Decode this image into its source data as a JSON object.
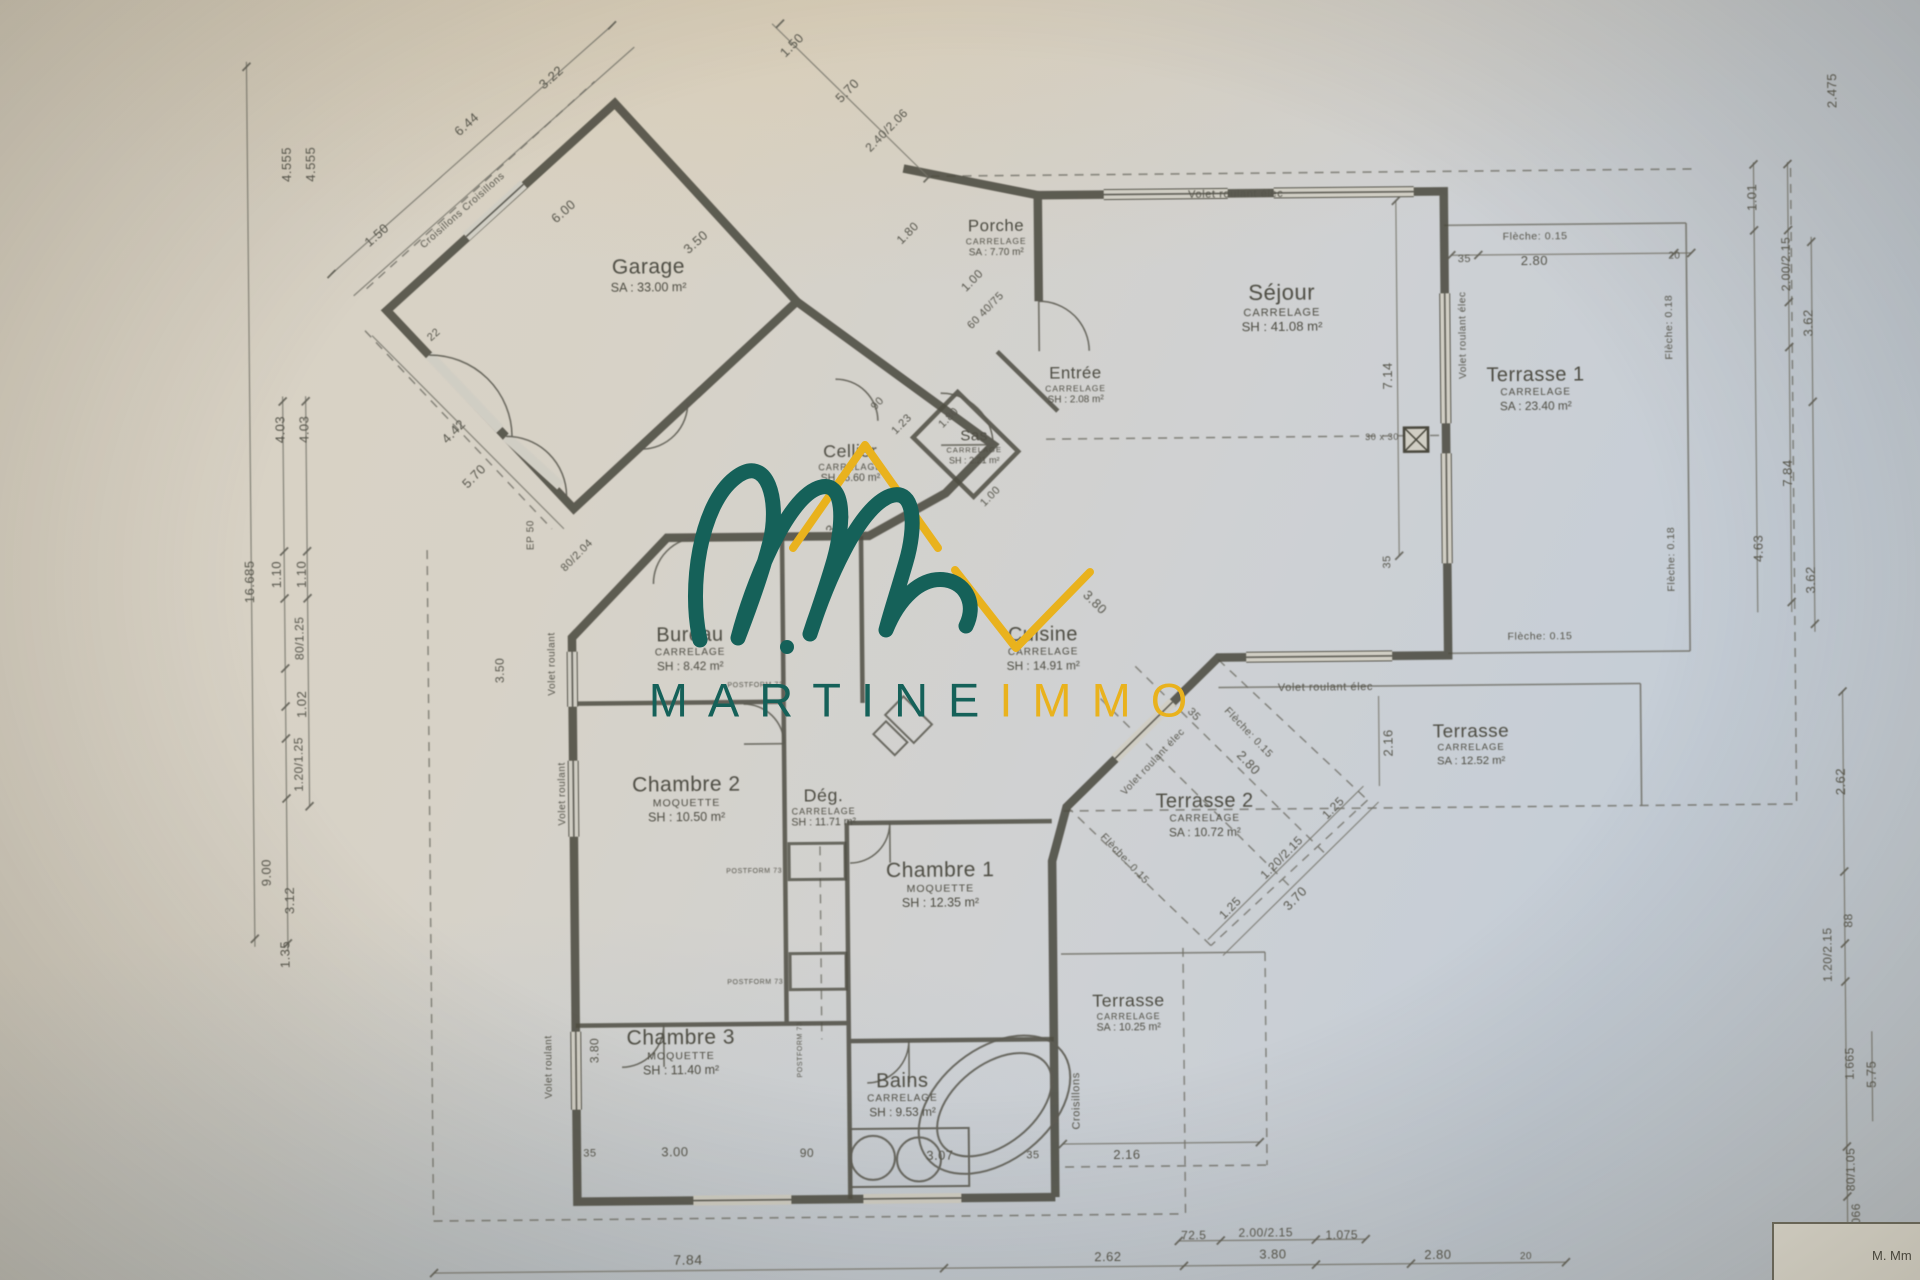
{
  "photo": {
    "accent_teal": "#156159",
    "accent_gold": "#e9b21d",
    "paper": "#d5d0c6",
    "ink": "#4c4b41"
  },
  "watermark": {
    "logo": "martineimmo-roof-and-script-m",
    "text_primary": "MARTINE",
    "text_secondary": "IMMO"
  },
  "title_block": {
    "text": "M. Mm"
  },
  "rooms": [
    {
      "id": "garage",
      "name": "Garage",
      "finish": "",
      "area": "SA : 33.00 m²",
      "x": 652,
      "y": 272,
      "scale": 1
    },
    {
      "id": "porche",
      "name": "Porche",
      "finish": "CARRELAGE",
      "area": "SA : 7.70 m²",
      "x": 1000,
      "y": 238,
      "scale": 0.8
    },
    {
      "id": "entree",
      "name": "Entrée",
      "finish": "CARRELAGE",
      "area": "SH : 2.08 m²",
      "x": 1078,
      "y": 386,
      "scale": 0.8
    },
    {
      "id": "sas",
      "name": "Sas",
      "finish": "CARRELAGE",
      "area": "SH : 2.21 m²",
      "x": 976,
      "y": 447,
      "scale": 0.72
    },
    {
      "id": "cellier",
      "name": "Cellier",
      "finish": "CARRELAGE",
      "area": "SH : 6.60 m²",
      "x": 852,
      "y": 462,
      "scale": 0.85
    },
    {
      "id": "sejour",
      "name": "Séjour",
      "finish": "CARRELAGE",
      "area": "SH : 41.08 m²",
      "x": 1285,
      "y": 311,
      "scale": 1.05
    },
    {
      "id": "terrasse1",
      "name": "Terrasse 1",
      "finish": "CARRELAGE",
      "area": "SA : 23.40 m²",
      "x": 1538,
      "y": 394,
      "scale": 0.95
    },
    {
      "id": "bureau",
      "name": "Bureau",
      "finish": "CARRELAGE",
      "area": "SH : 8.42 m²",
      "x": 690,
      "y": 646,
      "scale": 0.95
    },
    {
      "id": "cuisine",
      "name": "Cuisine",
      "finish": "CARRELAGE",
      "area": "SH : 14.91 m²",
      "x": 1043,
      "y": 649,
      "scale": 0.95
    },
    {
      "id": "chambre2",
      "name": "Chambre 2",
      "finish": "MOQUETTE",
      "area": "SH : 10.50 m²",
      "x": 685,
      "y": 796,
      "scale": 1
    },
    {
      "id": "degagement",
      "name": "Dég.",
      "finish": "CARRELAGE",
      "area": "SH : 11.71 m²",
      "x": 822,
      "y": 806,
      "scale": 0.85
    },
    {
      "id": "chambre1",
      "name": "Chambre 1",
      "finish": "MOQUETTE",
      "area": "SH : 12.35 m²",
      "x": 938,
      "y": 884,
      "scale": 1
    },
    {
      "id": "terrasse2",
      "name": "Terrasse 2",
      "finish": "CARRELAGE",
      "area": "SA : 10.72 m²",
      "x": 1203,
      "y": 817,
      "scale": 0.95
    },
    {
      "id": "terrasse_est",
      "name": "Terrasse",
      "finish": "CARRELAGE",
      "area": "SA : 12.52 m²",
      "x": 1470,
      "y": 749,
      "scale": 0.9
    },
    {
      "id": "chambre3",
      "name": "Chambre 3",
      "finish": "MOQUETTE",
      "area": "SH : 11.40 m²",
      "x": 677,
      "y": 1049,
      "scale": 1
    },
    {
      "id": "bains",
      "name": "Bains",
      "finish": "CARRELAGE",
      "area": "SH : 9.53 m²",
      "x": 898,
      "y": 1094,
      "scale": 0.95
    },
    {
      "id": "terrasse_sud",
      "name": "Terrasse",
      "finish": "CARRELAGE",
      "area": "SA : 10.25 m²",
      "x": 1125,
      "y": 1014,
      "scale": 0.85
    }
  ],
  "annotations": [
    {
      "t": "Volet roulant élec",
      "x": 1240,
      "y": 197,
      "r": 0,
      "s": 11
    },
    {
      "t": "Volet roulant élec",
      "x": 1325,
      "y": 691,
      "r": 0,
      "s": 11
    },
    {
      "t": "Volet roulant élec",
      "x": 1466,
      "y": 340,
      "r": -90,
      "s": 10
    },
    {
      "t": "Volet roulant élec",
      "x": 1152,
      "y": 764,
      "r": -46,
      "s": 10
    },
    {
      "t": "Volet roulant",
      "x": 552,
      "y": 660,
      "r": -90,
      "s": 10
    },
    {
      "t": "Volet roulant",
      "x": 561,
      "y": 790,
      "r": -90,
      "s": 10
    },
    {
      "t": "Volet roulant",
      "x": 545,
      "y": 1063,
      "r": -90,
      "s": 10
    },
    {
      "t": "EP 50",
      "x": 532,
      "y": 531,
      "r": -90,
      "s": 10
    },
    {
      "t": "Croisillons",
      "x": 1072,
      "y": 1102,
      "r": -90,
      "s": 11
    },
    {
      "t": "Croisillons      Croisillons",
      "x": 467,
      "y": 206,
      "r": -41,
      "s": 10
    },
    {
      "t": "POSTFORM 73",
      "x": 755,
      "y": 684,
      "r": 0,
      "s": 7
    },
    {
      "t": "POSTFORM 73",
      "x": 752,
      "y": 870,
      "r": 0,
      "s": 7
    },
    {
      "t": "POSTFORM 73",
      "x": 752,
      "y": 981,
      "r": 0,
      "s": 7
    },
    {
      "t": "POSTFORM 73",
      "x": 797,
      "y": 1048,
      "r": -90,
      "s": 7
    },
    {
      "t": "30 x 30",
      "x": 1384,
      "y": 441,
      "r": 0,
      "s": 9
    },
    {
      "t": "Flèche: 0.15",
      "x": 1539,
      "y": 243,
      "r": 0,
      "s": 10.5
    },
    {
      "t": "Flèche: 0.15",
      "x": 1540,
      "y": 643,
      "r": 0,
      "s": 10.5
    },
    {
      "t": "Flèche: 0.18",
      "x": 1673,
      "y": 334,
      "r": -90,
      "s": 10.5
    },
    {
      "t": "Flèche: 0.18",
      "x": 1673,
      "y": 566,
      "r": -90,
      "s": 10.5
    },
    {
      "t": "Flèche: 0.15",
      "x": 1247,
      "y": 736,
      "r": 47,
      "s": 10.5
    },
    {
      "t": "Flèche: 0.15",
      "x": 1122,
      "y": 861,
      "r": 47,
      "s": 10.5
    }
  ],
  "dimensions": [
    {
      "t": "6.44",
      "x": 472,
      "y": 120,
      "r": -41,
      "s": 13
    },
    {
      "t": "3.22",
      "x": 557,
      "y": 74,
      "r": -41,
      "s": 13
    },
    {
      "t": "1.50",
      "x": 381,
      "y": 230,
      "r": -41,
      "s": 13
    },
    {
      "t": "6.00",
      "x": 568,
      "y": 208,
      "r": -41,
      "s": 13
    },
    {
      "t": "3.50",
      "x": 700,
      "y": 240,
      "r": -41,
      "s": 13
    },
    {
      "t": "22",
      "x": 437,
      "y": 330,
      "r": -41,
      "s": 11
    },
    {
      "t": "4.42",
      "x": 456,
      "y": 427,
      "r": -45,
      "s": 13
    },
    {
      "t": "5.70",
      "x": 476,
      "y": 472,
      "r": -45,
      "s": 13
    },
    {
      "t": "3.00",
      "x": 839,
      "y": 522,
      "r": -45,
      "s": 13
    },
    {
      "t": "80/2.04",
      "x": 578,
      "y": 552,
      "r": -45,
      "s": 11
    },
    {
      "t": "1.50",
      "x": 798,
      "y": 44,
      "r": -45,
      "s": 13
    },
    {
      "t": "5.70",
      "x": 853,
      "y": 90,
      "r": -45,
      "s": 13
    },
    {
      "t": "2.40/2.06",
      "x": 892,
      "y": 130,
      "r": -45,
      "s": 12
    },
    {
      "t": "1.80",
      "x": 912,
      "y": 233,
      "r": -45,
      "s": 12
    },
    {
      "t": "1.00",
      "x": 976,
      "y": 281,
      "r": -45,
      "s": 12
    },
    {
      "t": "60 40/75",
      "x": 989,
      "y": 311,
      "r": -45,
      "s": 11
    },
    {
      "t": "90",
      "x": 880,
      "y": 403,
      "r": -45,
      "s": 11
    },
    {
      "t": "1.23",
      "x": 904,
      "y": 424,
      "r": -45,
      "s": 11
    },
    {
      "t": "1.80",
      "x": 951,
      "y": 418,
      "r": -45,
      "s": 11
    },
    {
      "t": "1.00",
      "x": 992,
      "y": 497,
      "r": -45,
      "s": 11
    },
    {
      "t": "3.80",
      "x": 1095,
      "y": 604,
      "r": 45,
      "s": 13
    },
    {
      "t": "35",
      "x": 1193,
      "y": 717,
      "r": 47,
      "s": 11
    },
    {
      "t": "2.80",
      "x": 1247,
      "y": 766,
      "r": 47,
      "s": 13
    },
    {
      "t": "1.25",
      "x": 1228,
      "y": 911,
      "r": -45,
      "s": 12
    },
    {
      "t": "1.20/2.15",
      "x": 1280,
      "y": 861,
      "r": -45,
      "s": 12
    },
    {
      "t": "1.25",
      "x": 1332,
      "y": 812,
      "r": -45,
      "s": 12
    },
    {
      "t": "3.70",
      "x": 1293,
      "y": 902,
      "r": -45,
      "s": 13
    },
    {
      "t": "35",
      "x": 1468,
      "y": 264,
      "r": 0,
      "s": 11
    },
    {
      "t": "2.80",
      "x": 1538,
      "y": 267,
      "r": 0,
      "s": 13
    },
    {
      "t": "20",
      "x": 1678,
      "y": 263,
      "r": 0,
      "s": 10
    },
    {
      "t": "7.14",
      "x": 1391,
      "y": 380,
      "r": -90,
      "s": 13
    },
    {
      "t": "35",
      "x": 1388,
      "y": 566,
      "r": -90,
      "s": 11
    },
    {
      "t": "2.16",
      "x": 1388,
      "y": 747,
      "r": -90,
      "s": 13
    },
    {
      "t": "2.16",
      "x": 1122,
      "y": 1157,
      "r": 0,
      "s": 13
    },
    {
      "t": "4.555",
      "x": 292,
      "y": 158,
      "r": -90,
      "s": 13
    },
    {
      "t": "4.555",
      "x": 316,
      "y": 158,
      "r": -90,
      "s": 13
    },
    {
      "t": "4.03",
      "x": 283,
      "y": 423,
      "r": -90,
      "s": 13
    },
    {
      "t": "4.03",
      "x": 307,
      "y": 423,
      "r": -90,
      "s": 13
    },
    {
      "t": "16.685",
      "x": 251,
      "y": 575,
      "r": -90,
      "s": 13
    },
    {
      "t": "1.10",
      "x": 278,
      "y": 568,
      "r": -90,
      "s": 13
    },
    {
      "t": "1.10",
      "x": 303,
      "y": 568,
      "r": -90,
      "s": 13
    },
    {
      "t": "80/1.25",
      "x": 300,
      "y": 632,
      "r": -90,
      "s": 12
    },
    {
      "t": "1.02",
      "x": 302,
      "y": 698,
      "r": -90,
      "s": 13
    },
    {
      "t": "1.20/1.25",
      "x": 298,
      "y": 758,
      "r": -90,
      "s": 12
    },
    {
      "t": "9.00",
      "x": 265,
      "y": 866,
      "r": -90,
      "s": 13
    },
    {
      "t": "3.12",
      "x": 288,
      "y": 894,
      "r": -90,
      "s": 13
    },
    {
      "t": "1.35",
      "x": 283,
      "y": 948,
      "r": -90,
      "s": 13
    },
    {
      "t": "2.475",
      "x": 1838,
      "y": 99,
      "r": -90,
      "s": 13
    },
    {
      "t": "1.01",
      "x": 1757,
      "y": 205,
      "r": -90,
      "s": 13
    },
    {
      "t": "2.00/2.15",
      "x": 1790,
      "y": 272,
      "r": -90,
      "s": 12
    },
    {
      "t": "3.62",
      "x": 1812,
      "y": 331,
      "r": -90,
      "s": 13
    },
    {
      "t": "7.84",
      "x": 1790,
      "y": 481,
      "r": -90,
      "s": 13
    },
    {
      "t": "4.63",
      "x": 1760,
      "y": 556,
      "r": -90,
      "s": 13
    },
    {
      "t": "3.62",
      "x": 1812,
      "y": 588,
      "r": -90,
      "s": 13
    },
    {
      "t": "2.62",
      "x": 1840,
      "y": 790,
      "r": -90,
      "s": 13
    },
    {
      "t": "88",
      "x": 1846,
      "y": 929,
      "r": -90,
      "s": 12
    },
    {
      "t": "1.20/2.15",
      "x": 1825,
      "y": 963,
      "r": -90,
      "s": 12
    },
    {
      "t": "1.665",
      "x": 1846,
      "y": 1072,
      "r": -90,
      "s": 12
    },
    {
      "t": "5.75",
      "x": 1868,
      "y": 1083,
      "r": -90,
      "s": 13
    },
    {
      "t": "80/1.05",
      "x": 1846,
      "y": 1178,
      "r": -90,
      "s": 12
    },
    {
      "t": "1.066",
      "x": 1851,
      "y": 1228,
      "r": -90,
      "s": 12
    },
    {
      "t": "35",
      "x": 585,
      "y": 1150,
      "r": 0,
      "s": 11
    },
    {
      "t": "3.00",
      "x": 670,
      "y": 1150,
      "r": 0,
      "s": 13
    },
    {
      "t": "90",
      "x": 802,
      "y": 1152,
      "r": 0,
      "s": 12
    },
    {
      "t": "3.07",
      "x": 935,
      "y": 1156,
      "r": 0,
      "s": 13
    },
    {
      "t": "35",
      "x": 1028,
      "y": 1156,
      "r": 0,
      "s": 11
    },
    {
      "t": "7.84",
      "x": 682,
      "y": 1258,
      "r": 0,
      "s": 14
    },
    {
      "t": "2.62",
      "x": 1102,
      "y": 1259,
      "r": 0,
      "s": 13
    },
    {
      "t": "72.5",
      "x": 1188,
      "y": 1238,
      "r": 0,
      "s": 12
    },
    {
      "t": "2.00/2.15",
      "x": 1260,
      "y": 1236,
      "r": 0,
      "s": 12
    },
    {
      "t": "1.075",
      "x": 1336,
      "y": 1239,
      "r": 0,
      "s": 12
    },
    {
      "t": "3.80",
      "x": 1267,
      "y": 1258,
      "r": 0,
      "s": 13
    },
    {
      "t": "2.80",
      "x": 1432,
      "y": 1260,
      "r": 0,
      "s": 13
    },
    {
      "t": "20",
      "x": 1520,
      "y": 1262,
      "r": 0,
      "s": 10
    },
    {
      "t": "3.50",
      "x": 500,
      "y": 666,
      "r": -90,
      "s": 12
    },
    {
      "t": "3.80",
      "x": 591,
      "y": 1047,
      "r": -90,
      "s": 12
    }
  ]
}
